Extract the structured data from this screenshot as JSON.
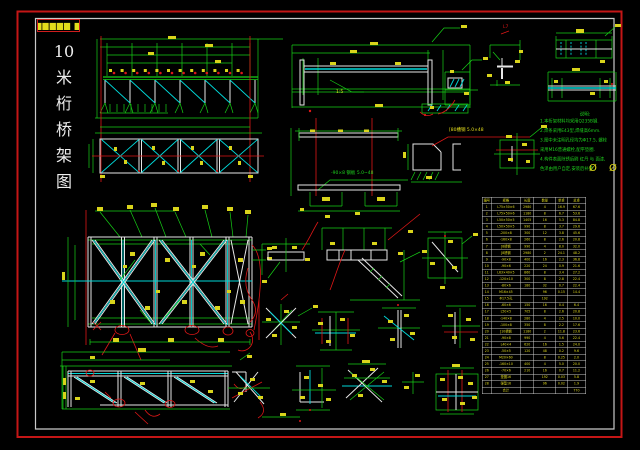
{
  "drawing": {
    "title_chars": [
      "10",
      "米",
      "桁",
      "桥",
      "架",
      "图"
    ],
    "stamp_text": "▆▆▆▆▆ ▆",
    "labels": {
      "plate_leader": "-90×8 钢板 5.0~48",
      "channel_leader": "[80槽钢 5.0×48",
      "scale": "1:5",
      "detail_ref": "L7"
    },
    "notes": {
      "title": "说明:",
      "lines": [
        "1.本桁架材料均采用Q235B钢.",
        "2.焊条采用E43型,焊缝高6mm.",
        "3.图中未注明孔径均为Φ17.5, 螺栓",
        "  采用M16普通螺栓,配平垫圈.",
        "4.构件表面除锈后刷 红丹 与 面漆,",
        "  色泽由用户自定,安装后补漆."
      ],
      "sym1": "Ø",
      "sym2": "Ø"
    },
    "table": {
      "headers": [
        "编号",
        "规格",
        "长度",
        "数量",
        "单重",
        "总重"
      ],
      "rows": [
        [
          "1",
          "L75×50×6",
          "2980",
          "4",
          "16.9",
          "67.6"
        ],
        [
          "2",
          "L75×50×6",
          "1180",
          "8",
          "6.7",
          "53.6"
        ],
        [
          "3",
          "L50×50×5",
          "1405",
          "16",
          "5.3",
          "84.8"
        ],
        [
          "4",
          "L50×50×5",
          "990",
          "8",
          "3.7",
          "29.6"
        ],
        [
          "5",
          "-200×8",
          "300",
          "12",
          "3.8",
          "45.6"
        ],
        [
          "6",
          "-160×8",
          "260",
          "8",
          "2.6",
          "20.8"
        ],
        [
          "7",
          "[8槽钢",
          "990",
          "4",
          "8.0",
          "32.0"
        ],
        [
          "8",
          "[8槽钢",
          "2980",
          "2",
          "24.1",
          "48.2"
        ],
        [
          "9",
          "-90×8",
          "400",
          "16",
          "2.3",
          "36.8"
        ],
        [
          "10",
          "-90×6",
          "220",
          "24",
          "0.9",
          "21.6"
        ],
        [
          "11",
          "L63×40×5",
          "860",
          "8",
          "3.4",
          "27.2"
        ],
        [
          "12",
          "-120×10",
          "300",
          "8",
          "2.8",
          "22.4"
        ],
        [
          "13",
          "-80×6",
          "180",
          "32",
          "0.7",
          "22.4"
        ],
        [
          "14",
          "M16×45",
          "",
          "96",
          "0.15",
          "14.4"
        ],
        [
          "15",
          "Φ17.5孔",
          "",
          "192",
          "",
          ""
        ],
        [
          "16",
          "-60×6",
          "150",
          "16",
          "0.4",
          "6.4"
        ],
        [
          "17",
          "L50×5",
          "705",
          "8",
          "2.6",
          "20.8"
        ],
        [
          "18",
          "-140×8",
          "280",
          "4",
          "2.5",
          "10.0"
        ],
        [
          "19",
          "-100×8",
          "350",
          "8",
          "2.2",
          "17.6"
        ],
        [
          "20",
          "[10槽钢",
          "1180",
          "2",
          "11.8",
          "23.6"
        ],
        [
          "21",
          "-90×8",
          "990",
          "4",
          "5.6",
          "22.4"
        ],
        [
          "22",
          "L40×4",
          "620",
          "16",
          "1.5",
          "24.0"
        ],
        [
          "23",
          "-50×5",
          "120",
          "48",
          "0.2",
          "9.6"
        ],
        [
          "24",
          "M20×60",
          "",
          "8",
          "0.25",
          "2.0"
        ],
        [
          "25",
          "-160×10",
          "400",
          "4",
          "5.0",
          "20.0"
        ],
        [
          "26",
          "-70×6",
          "210",
          "16",
          "0.7",
          "11.2"
        ],
        [
          "27",
          "垫圈16",
          "",
          "192",
          "0.03",
          "5.8"
        ],
        [
          "28",
          "弹垫16",
          "",
          "96",
          "0.02",
          "1.9"
        ]
      ],
      "total_row": [
        "",
        "合计",
        "",
        "",
        "",
        "770"
      ]
    },
    "colors": {
      "background": "#000000",
      "frame_outer": "#c41616",
      "frame_inner": "#c9c9c9",
      "line_green": "#16cf16",
      "line_cyan": "#00d9d9",
      "line_white": "#e6e6e6",
      "line_red": "#df1717",
      "tag_yellow": "#d9d41b"
    }
  }
}
